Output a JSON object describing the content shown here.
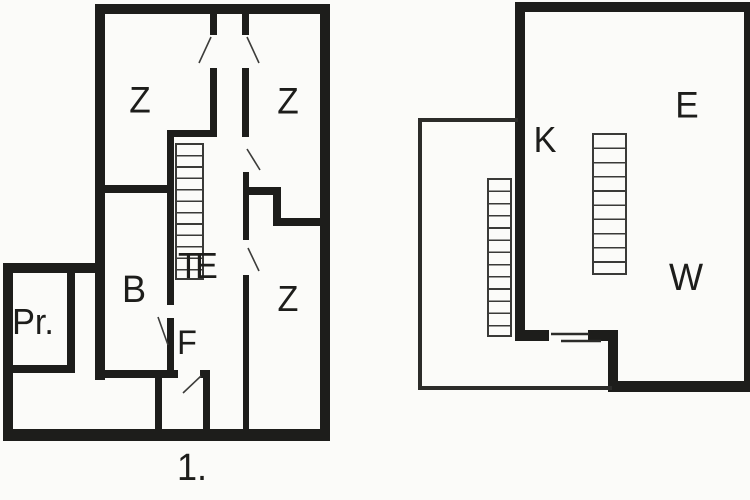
{
  "figure": {
    "type": "floor-plan-drawing",
    "background_color": "#fbfbf9",
    "wall_color": "#1d1d1b",
    "floor_label": "1.",
    "left_plan": {
      "labels": {
        "z_top_left": "Z",
        "z_top_right": "Z",
        "z_bottom_right": "Z",
        "stair_hall": "TE",
        "room_b": "B",
        "room_pr": "Pr.",
        "room_f": "F"
      }
    },
    "right_plan": {
      "labels": {
        "room_k": "K",
        "room_e": "E",
        "room_w": "W"
      }
    }
  }
}
